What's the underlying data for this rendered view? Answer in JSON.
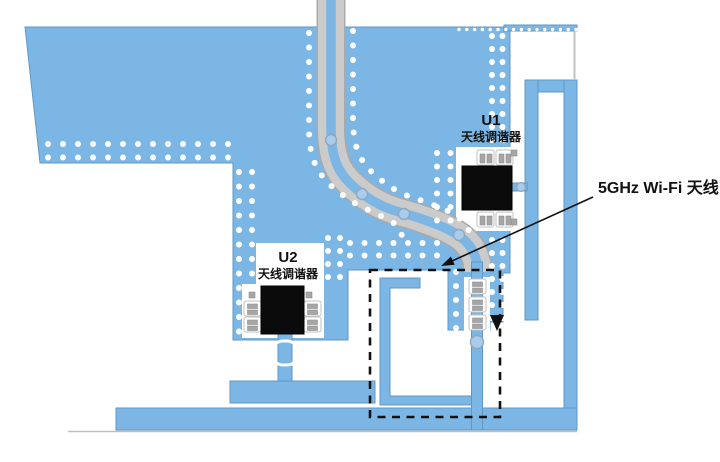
{
  "diagram": {
    "type": "pcb-antenna-layout",
    "callout_label": "5GHz Wi-Fi 天线",
    "u1": {
      "ref": "U1",
      "name": "天线调谐器"
    },
    "u2": {
      "ref": "U2",
      "name": "天线调谐器"
    },
    "colors": {
      "copper": "#7cb6e4",
      "copper_border": "#5f98c7",
      "via": "#ffffff",
      "trace_gray": "#cbcbcb",
      "trace_gray_edge": "#a9a9a9",
      "chip": "#0b0b0b",
      "annotation": "#111111",
      "background": "#ffffff"
    }
  }
}
